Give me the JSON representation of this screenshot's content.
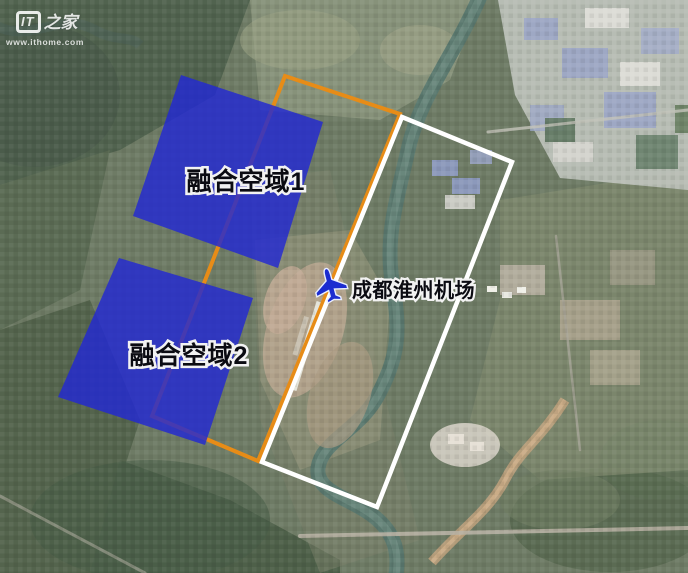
{
  "page": {
    "width": 688,
    "height": 573
  },
  "watermark": {
    "logo_it": "IT",
    "logo_suffix": "之家",
    "url": "www.ithome.com"
  },
  "map": {
    "zones": [
      {
        "label": "融合空域1",
        "points": "181,75 323,122 278,268 133,216",
        "fill": "#2228d2",
        "fill_opacity": 0.82,
        "label_x": 246,
        "label_y": 190
      },
      {
        "label": "融合空域2",
        "points": "119,258 253,298 205,445 58,397",
        "fill": "#2228d2",
        "fill_opacity": 0.82,
        "label_x": 189,
        "label_y": 364
      }
    ],
    "outlines": [
      {
        "name": "orange-corridor",
        "points": "285,76 400,114 258,461 152,416",
        "stroke": "#e78c17",
        "stroke_width": 4
      },
      {
        "name": "white-boundary",
        "points": "402,117 512,162 377,507 262,462",
        "stroke": "#ffffff",
        "stroke_width": 4.5
      }
    ],
    "airport": {
      "label": "成都淮州机场",
      "label_x": 352,
      "label_y": 297,
      "icon_x": 330,
      "icon_y": 284,
      "icon_rotation": -15,
      "icon_fill": "#1b2cd0"
    }
  }
}
